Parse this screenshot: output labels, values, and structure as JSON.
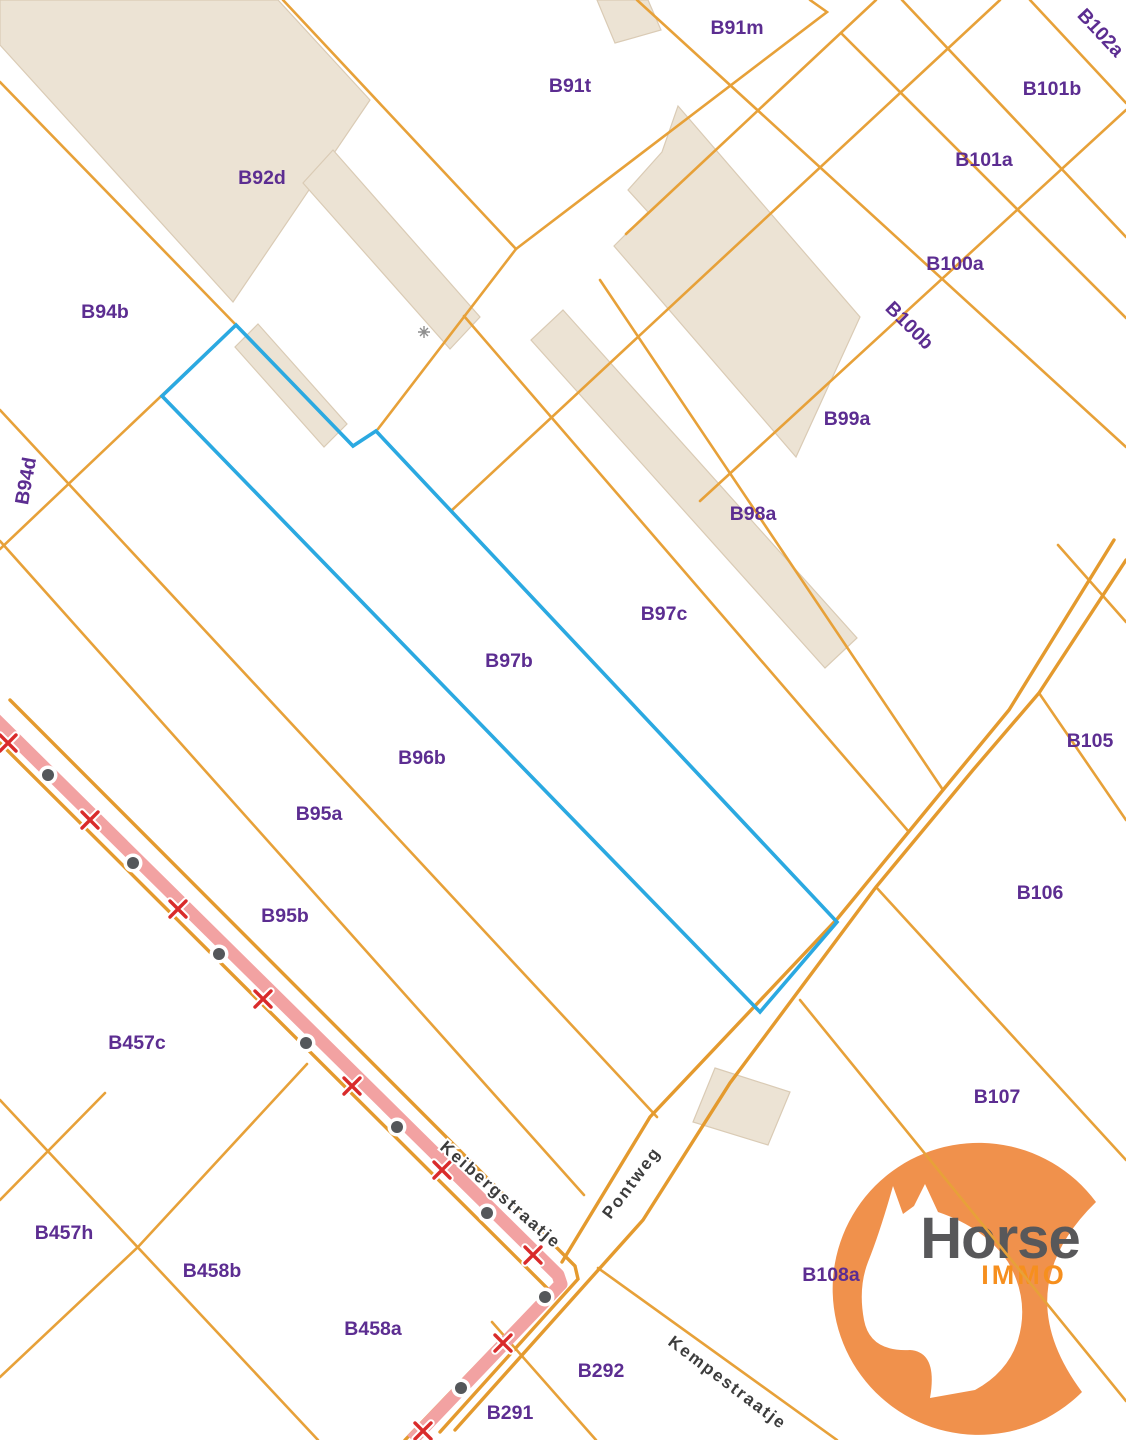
{
  "map": {
    "colors": {
      "background": "#ffffff",
      "parcel_line": "#E7A139",
      "road_line": "#E49A2E",
      "highlight": "#2BA9E1",
      "building_fill": "#ECE3D4",
      "building_stroke": "#DACBB5",
      "path_fill": "#F2A2A2",
      "marker_x": "#D92B2B",
      "marker_dot": "#54575A",
      "label_purple": "#5C2D91",
      "street_text": "#3C3C3C",
      "street_halo": "#ffffff"
    },
    "parcel_labels": [
      {
        "text": "B91m",
        "x": 737,
        "y": 34,
        "rot": 0
      },
      {
        "text": "B91t",
        "x": 570,
        "y": 92,
        "rot": 0
      },
      {
        "text": "B102a",
        "x": 1096,
        "y": 37,
        "rot": 47
      },
      {
        "text": "B101b",
        "x": 1052,
        "y": 95,
        "rot": 0
      },
      {
        "text": "B101a",
        "x": 984,
        "y": 166,
        "rot": 0
      },
      {
        "text": "B100a",
        "x": 955,
        "y": 270,
        "rot": 0
      },
      {
        "text": "B100b",
        "x": 905,
        "y": 330,
        "rot": 45
      },
      {
        "text": "B92d",
        "x": 262,
        "y": 184,
        "rot": 0
      },
      {
        "text": "B94b",
        "x": 105,
        "y": 318,
        "rot": 0
      },
      {
        "text": "B94d",
        "x": 32,
        "y": 482,
        "rot": -80
      },
      {
        "text": "B99a",
        "x": 847,
        "y": 425,
        "rot": 0
      },
      {
        "text": "B98a",
        "x": 753,
        "y": 520,
        "rot": 0
      },
      {
        "text": "B97c",
        "x": 664,
        "y": 620,
        "rot": 0
      },
      {
        "text": "B97b",
        "x": 509,
        "y": 667,
        "rot": 0
      },
      {
        "text": "B96b",
        "x": 422,
        "y": 764,
        "rot": 0
      },
      {
        "text": "B95a",
        "x": 319,
        "y": 820,
        "rot": 0
      },
      {
        "text": "B95b",
        "x": 285,
        "y": 922,
        "rot": 0
      },
      {
        "text": "B457c",
        "x": 137,
        "y": 1049,
        "rot": 0
      },
      {
        "text": "B457h",
        "x": 64,
        "y": 1239,
        "rot": 0
      },
      {
        "text": "B458b",
        "x": 212,
        "y": 1277,
        "rot": 0
      },
      {
        "text": "B458a",
        "x": 373,
        "y": 1335,
        "rot": 0
      },
      {
        "text": "B291",
        "x": 510,
        "y": 1419,
        "rot": 0
      },
      {
        "text": "B292",
        "x": 601,
        "y": 1377,
        "rot": 0
      },
      {
        "text": "B105",
        "x": 1090,
        "y": 747,
        "rot": 0
      },
      {
        "text": "B106",
        "x": 1040,
        "y": 899,
        "rot": 0
      },
      {
        "text": "B107",
        "x": 997,
        "y": 1103,
        "rot": 0
      },
      {
        "text": "B108a",
        "x": 831,
        "y": 1281,
        "rot": 0
      }
    ],
    "street_labels": [
      {
        "text": "Keibergstraatje",
        "x": 497,
        "y": 1199,
        "rot": 41,
        "anchor": "middle"
      },
      {
        "text": "Pontweg",
        "x": 636,
        "y": 1186,
        "rot": -53,
        "anchor": "middle"
      },
      {
        "text": "Kempestraatje",
        "x": 667,
        "y": 1344,
        "rot": 37,
        "anchor": "start"
      }
    ],
    "parcel_lines": [
      {
        "pts": [
          [
            0,
            82
          ],
          [
            236,
            325
          ]
        ]
      },
      {
        "pts": [
          [
            236,
            325
          ],
          [
            0,
            549
          ]
        ]
      },
      {
        "pts": [
          [
            0,
            410
          ],
          [
            657,
            1117
          ]
        ]
      },
      {
        "pts": [
          [
            0,
            541
          ],
          [
            584,
            1195
          ]
        ]
      },
      {
        "pts": [
          [
            637,
            0
          ],
          [
            1126,
            447
          ]
        ]
      },
      {
        "pts": [
          [
            810,
            0
          ],
          [
            827,
            12
          ],
          [
            516,
            249
          ]
        ]
      },
      {
        "pts": [
          [
            283,
            0
          ],
          [
            516,
            249
          ]
        ]
      },
      {
        "pts": [
          [
            516,
            249
          ],
          [
            378,
            429
          ]
        ]
      },
      {
        "pts": [
          [
            876,
            0
          ],
          [
            626,
            234
          ]
        ]
      },
      {
        "pts": [
          [
            1000,
            0
          ],
          [
            451,
            511
          ]
        ]
      },
      {
        "pts": [
          [
            1126,
            110
          ],
          [
            700,
            501
          ]
        ]
      },
      {
        "pts": [
          [
            600,
            280
          ],
          [
            943,
            790
          ]
        ]
      },
      {
        "pts": [
          [
            464,
            316
          ],
          [
            909,
            832
          ]
        ]
      },
      {
        "pts": [
          [
            1030,
            0
          ],
          [
            1126,
            103
          ]
        ]
      },
      {
        "pts": [
          [
            902,
            0
          ],
          [
            1126,
            237
          ]
        ]
      },
      {
        "pts": [
          [
            841,
            33
          ],
          [
            1126,
            318
          ]
        ]
      },
      {
        "pts": [
          [
            1039,
            693
          ],
          [
            1126,
            820
          ]
        ]
      },
      {
        "pts": [
          [
            1058,
            545
          ],
          [
            1126,
            622
          ]
        ]
      },
      {
        "pts": [
          [
            876,
            887
          ],
          [
            1126,
            1160
          ]
        ]
      },
      {
        "pts": [
          [
            598,
            1268
          ],
          [
            837,
            1440
          ]
        ]
      },
      {
        "pts": [
          [
            492,
            1322
          ],
          [
            596,
            1440
          ]
        ]
      },
      {
        "pts": [
          [
            307,
            1064
          ],
          [
            138,
            1247
          ],
          [
            0,
            1377
          ]
        ]
      },
      {
        "pts": [
          [
            0,
            1100
          ],
          [
            318,
            1440
          ]
        ]
      },
      {
        "pts": [
          [
            105,
            1093
          ],
          [
            0,
            1200
          ]
        ]
      }
    ],
    "road_lines": [
      {
        "pts": [
          [
            1114,
            540
          ],
          [
            1009,
            710
          ],
          [
            943,
            790
          ],
          [
            838,
            918
          ],
          [
            650,
            1117
          ],
          [
            562,
            1262
          ]
        ]
      },
      {
        "pts": [
          [
            1126,
            560
          ],
          [
            1039,
            693
          ],
          [
            973,
            770
          ],
          [
            876,
            887
          ],
          [
            730,
            1083
          ],
          [
            643,
            1220
          ],
          [
            455,
            1430
          ]
        ]
      },
      {
        "pts": [
          [
            10,
            700
          ],
          [
            575,
            1266
          ],
          [
            578,
            1279
          ],
          [
            440,
            1432
          ]
        ]
      },
      {
        "pts": [
          [
            0,
            743
          ],
          [
            549,
            1290
          ],
          [
            405,
            1440
          ]
        ]
      }
    ],
    "overlay_lines": [
      {
        "pts": [
          [
            800,
            1000
          ],
          [
            1126,
            1401
          ]
        ]
      }
    ],
    "buildings": [
      {
        "pts": [
          [
            0,
            0
          ],
          [
            278,
            0
          ],
          [
            370,
            100
          ],
          [
            233,
            302
          ],
          [
            0,
            45
          ]
        ]
      },
      {
        "pts": [
          [
            333,
            150
          ],
          [
            480,
            317
          ],
          [
            450,
            349
          ],
          [
            303,
            183
          ]
        ]
      },
      {
        "pts": [
          [
            258,
            324
          ],
          [
            347,
            424
          ],
          [
            324,
            447
          ],
          [
            235,
            347
          ]
        ]
      },
      {
        "pts": [
          [
            678,
            106
          ],
          [
            860,
            317
          ],
          [
            796,
            457
          ],
          [
            614,
            246
          ],
          [
            648,
            212
          ],
          [
            628,
            190
          ],
          [
            662,
            152
          ]
        ]
      },
      {
        "pts": [
          [
            563,
            310
          ],
          [
            857,
            638
          ],
          [
            825,
            668
          ],
          [
            531,
            340
          ]
        ]
      },
      {
        "pts": [
          [
            715,
            1068
          ],
          [
            790,
            1092
          ],
          [
            768,
            1145
          ],
          [
            693,
            1122
          ]
        ]
      },
      {
        "pts": [
          [
            597,
            0
          ],
          [
            648,
            0
          ],
          [
            661,
            30
          ],
          [
            615,
            43
          ]
        ]
      }
    ],
    "highlight_parcel": {
      "pts": [
        [
          236,
          325
        ],
        [
          353,
          446
        ],
        [
          376,
          431
        ],
        [
          837,
          922
        ],
        [
          760,
          1012
        ],
        [
          162,
          396
        ]
      ]
    },
    "path_road": {
      "pts": [
        [
          -8,
          716
        ],
        [
          558,
          1275
        ],
        [
          561,
          1284
        ],
        [
          412,
          1440
        ]
      ],
      "x_markers": [
        [
          8,
          743
        ],
        [
          90,
          820
        ],
        [
          178,
          909
        ],
        [
          263,
          999
        ],
        [
          352,
          1086
        ],
        [
          442,
          1170
        ],
        [
          533,
          1255
        ],
        [
          503,
          1343
        ],
        [
          423,
          1431
        ]
      ],
      "dot_markers": [
        [
          48,
          775
        ],
        [
          133,
          863
        ],
        [
          219,
          954
        ],
        [
          306,
          1043
        ],
        [
          397,
          1127
        ],
        [
          487,
          1213
        ],
        [
          545,
          1297
        ],
        [
          461,
          1388
        ]
      ]
    },
    "cross_symbol": {
      "x": 424,
      "y": 332
    }
  },
  "logo": {
    "brand": "Horse",
    "sub": "IMMO",
    "circle_color": "#F0914C",
    "brand_color": "#58585A",
    "sub_color": "#F68F1E"
  }
}
